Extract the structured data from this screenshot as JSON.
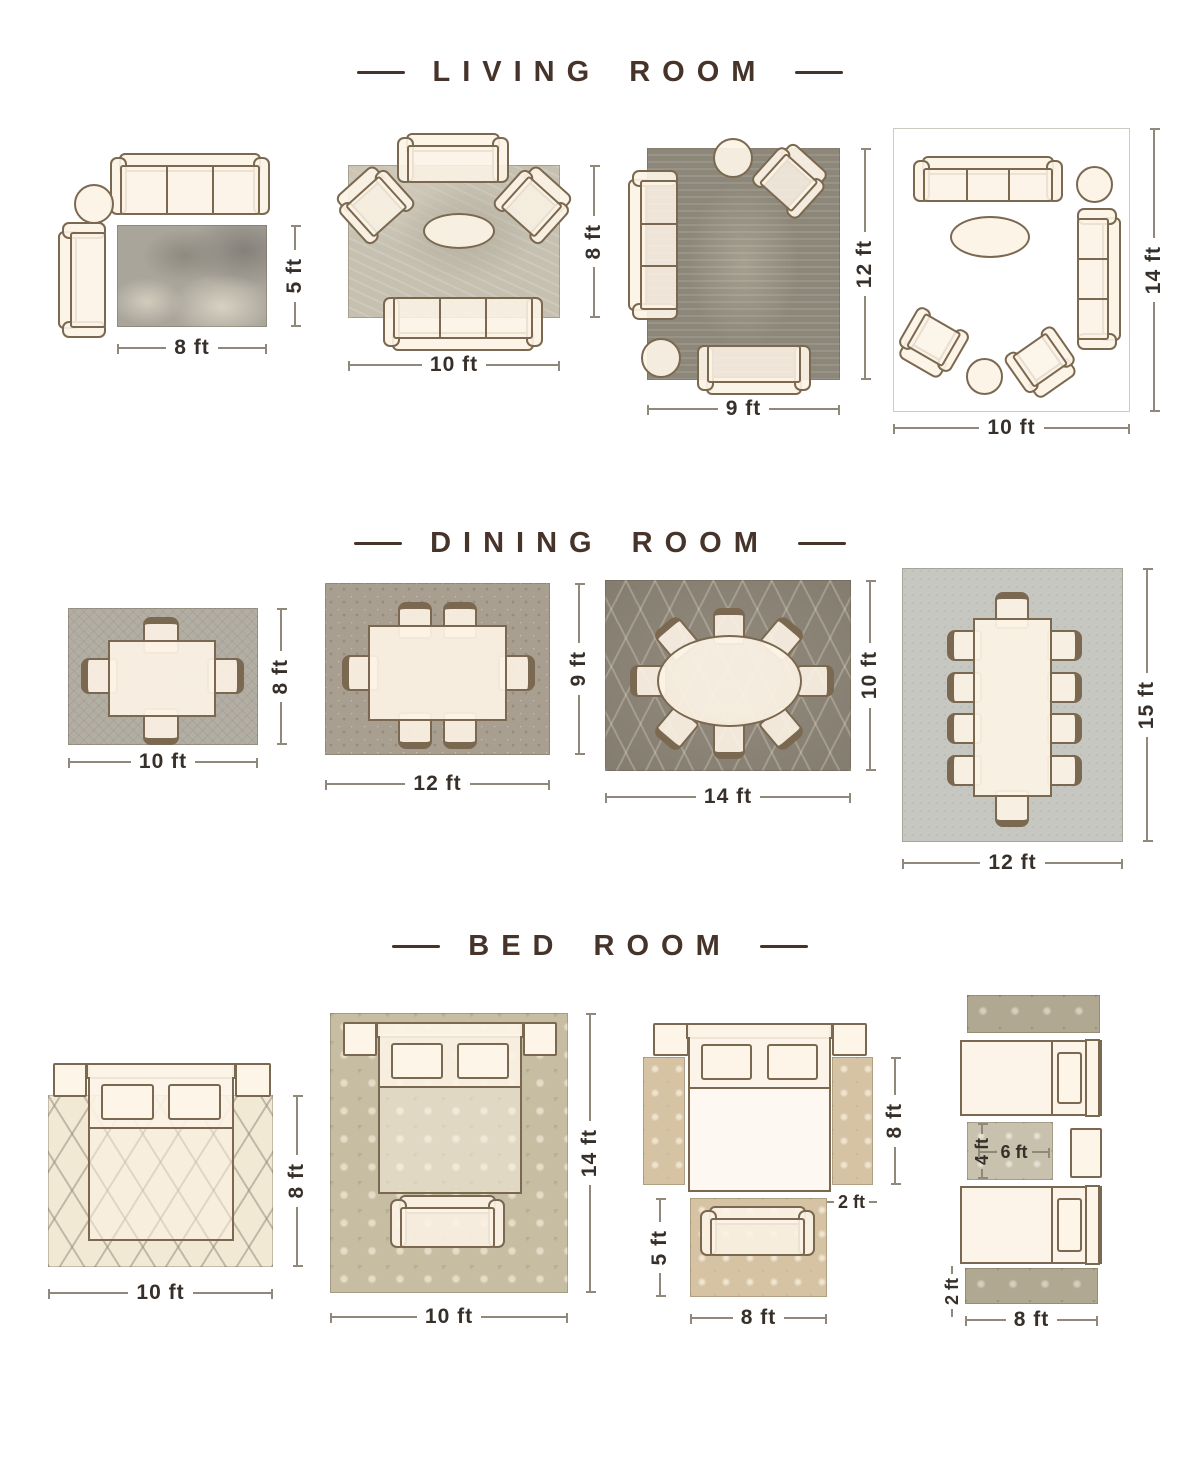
{
  "colors": {
    "background": "#ffffff",
    "heading_text": "#46342a",
    "dimension_text": "#37302a",
    "dimension_line": "#8f887b",
    "furniture_outline": "#7b6850",
    "furniture_fill": "#fbf2e3"
  },
  "sections": [
    {
      "id": "living-room",
      "title": "LIVING ROOM",
      "layouts": [
        {
          "id": "living-8x5",
          "labels": {
            "width": "8 ft",
            "height": "5 ft"
          },
          "furniture": [
            "3-seat sofa",
            "round side table",
            "loveseat"
          ]
        },
        {
          "id": "living-10x8",
          "labels": {
            "width": "10 ft",
            "height": "8 ft"
          },
          "furniture": [
            "loveseat",
            "2 armchairs",
            "oval coffee table",
            "3-seat sofa"
          ]
        },
        {
          "id": "living-9x12",
          "labels": {
            "width": "9 ft",
            "height": "12 ft"
          },
          "furniture": [
            "3-seat sofa",
            "armchair",
            "2 round side tables",
            "loveseat"
          ]
        },
        {
          "id": "living-10x14",
          "labels": {
            "width": "10 ft",
            "height": "14 ft"
          },
          "furniture": [
            "2 3-seat sofas",
            "2 armchairs",
            "oval coffee table",
            "2 round side tables"
          ]
        }
      ]
    },
    {
      "id": "dining-room",
      "title": "DINING ROOM",
      "layouts": [
        {
          "id": "dining-10x8",
          "labels": {
            "width": "10 ft",
            "height": "8 ft"
          },
          "furniture": [
            "dining table with 4 chairs"
          ]
        },
        {
          "id": "dining-12x9",
          "labels": {
            "width": "12 ft",
            "height": "9 ft"
          },
          "furniture": [
            "dining table with 6 chairs"
          ]
        },
        {
          "id": "dining-14x10",
          "labels": {
            "width": "14 ft",
            "height": "10 ft"
          },
          "furniture": [
            "oval dining table with 8 chairs"
          ]
        },
        {
          "id": "dining-12x15",
          "labels": {
            "width": "12 ft",
            "height": "15 ft"
          },
          "furniture": [
            "long dining table with 10 chairs"
          ]
        }
      ]
    },
    {
      "id": "bed-room",
      "title": "BED ROOM",
      "layouts": [
        {
          "id": "bed-10x8",
          "labels": {
            "width": "10 ft",
            "height": "8 ft"
          },
          "furniture": [
            "queen bed",
            "2 nightstands"
          ]
        },
        {
          "id": "bed-10x14",
          "labels": {
            "width": "10 ft",
            "height": "14 ft"
          },
          "furniture": [
            "queen bed",
            "2 nightstands",
            "bench"
          ]
        },
        {
          "id": "bed-runners",
          "labels": {
            "runner_height": "8 ft",
            "runner_width": "2 ft",
            "rug_height": "5 ft",
            "rug_width": "8 ft"
          },
          "furniture": [
            "queen bed",
            "2 nightstands",
            "2 runner rugs",
            "loveseat on accent rug"
          ]
        },
        {
          "id": "bed-twin",
          "labels": {
            "small_rug_height": "4 ft",
            "small_rug_width": "6 ft",
            "runner_width": "2 ft",
            "runner_length": "8 ft"
          },
          "furniture": [
            "2 twin beds",
            "nightstand",
            "2 runner rugs",
            "small rug"
          ]
        }
      ]
    }
  ]
}
